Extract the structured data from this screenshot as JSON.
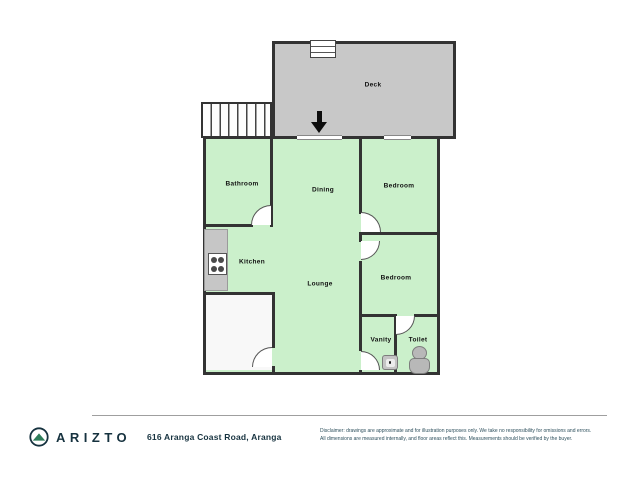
{
  "colors": {
    "room_fill": "#cbf0cb",
    "deck_fill": "#c8c8c8",
    "wall": "#333333",
    "brand_navy": "#16323f",
    "logo_green": "#2e7d5a"
  },
  "floor_plan": {
    "rooms": {
      "deck": "Deck",
      "bathroom": "Bathroom",
      "dining": "Dining",
      "bedroom_top": "Bedroom",
      "kitchen": "Kitchen",
      "lounge": "Lounge",
      "bedroom_bottom": "Bedroom",
      "vanity": "Vanity",
      "toilet": "Toilet"
    },
    "icons": {
      "entry_arrow": "entry-arrow",
      "stove": "stove",
      "toilet_fixture": "toilet",
      "sink": "sink",
      "stairs": "stairs",
      "deck_steps": "steps"
    }
  },
  "footer": {
    "brand": "ARIZTO",
    "address": "616 Aranga Coast Road, Aranga",
    "disclaimer_line1": "Disclaimer: drawings are approximate and for illustration purposes only. We take no responsibility for omissions and errors.",
    "disclaimer_line2": "All dimensions are measured internally, and floor areas reflect this. Measurements should be verified by the buyer."
  }
}
